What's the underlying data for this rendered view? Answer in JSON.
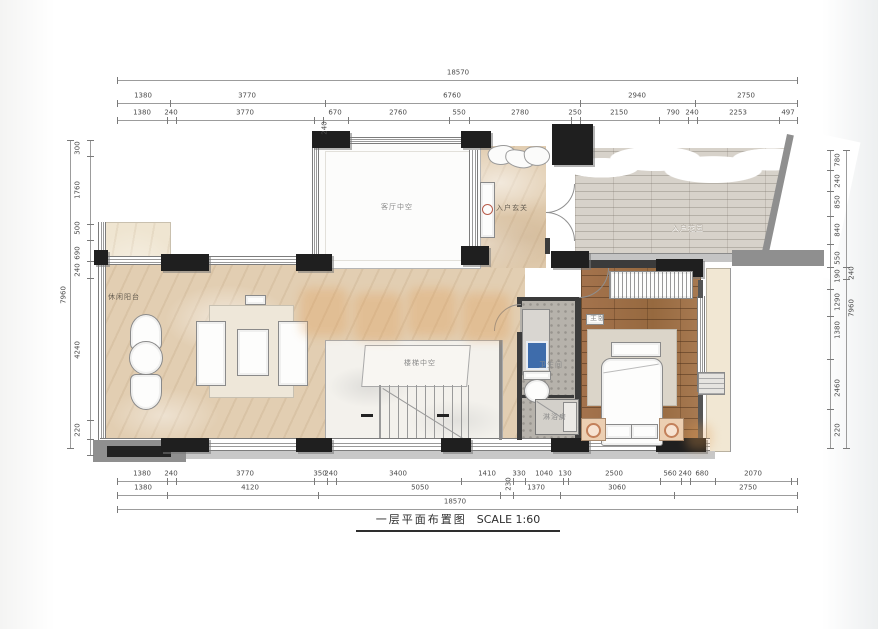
{
  "title": {
    "text": "一层平面布置图",
    "scale": "SCALE 1:60"
  },
  "rooms": {
    "labels": [
      {
        "t": "客厅中空",
        "x": 397,
        "y": 207,
        "cls": ""
      },
      {
        "t": "入户玄关",
        "x": 512,
        "y": 208,
        "cls": "onmarble"
      },
      {
        "t": "入户花园",
        "x": 688,
        "y": 228,
        "cls": "emboss"
      },
      {
        "t": "休闲阳台",
        "x": 124,
        "y": 297,
        "cls": "onmarble"
      },
      {
        "t": "楼梯中空",
        "x": 420,
        "y": 363,
        "cls": ""
      },
      {
        "t": "主卧",
        "x": 598,
        "y": 318,
        "cls": ""
      },
      {
        "t": "卫生间",
        "x": 551,
        "y": 365,
        "cls": ""
      },
      {
        "t": "淋浴房",
        "x": 555,
        "y": 417,
        "cls": ""
      }
    ]
  },
  "dimensions": {
    "unit": "mm",
    "overall": {
      "width": "18570",
      "height": "7960"
    },
    "top": {
      "rows": [
        {
          "y": 73,
          "items": [
            {
              "t": "18570",
              "x": 458
            }
          ]
        },
        {
          "y": 96,
          "items": [
            {
              "t": "1380",
              "x": 143
            },
            {
              "t": "3770",
              "x": 247
            },
            {
              "t": "6760",
              "x": 452
            },
            {
              "t": "2940",
              "x": 637
            },
            {
              "t": "2750",
              "x": 746
            }
          ]
        },
        {
          "y": 113,
          "items": [
            {
              "t": "1380",
              "x": 142
            },
            {
              "t": "240",
              "x": 171
            },
            {
              "t": "3770",
              "x": 245
            },
            {
              "t": "670",
              "x": 335
            },
            {
              "t": "2760",
              "x": 398
            },
            {
              "t": "550",
              "x": 459
            },
            {
              "t": "2780",
              "x": 520
            },
            {
              "t": "250",
              "x": 575
            },
            {
              "t": "2150",
              "x": 619
            },
            {
              "t": "790",
              "x": 673
            },
            {
              "t": "240",
              "x": 692
            },
            {
              "t": "2253",
              "x": 738
            },
            {
              "t": "497",
              "x": 788
            }
          ]
        }
      ]
    },
    "bottom": {
      "rows": [
        {
          "y": 474,
          "items": [
            {
              "t": "1380",
              "x": 142
            },
            {
              "t": "240",
              "x": 171
            },
            {
              "t": "3770",
              "x": 245
            },
            {
              "t": "350",
              "x": 320
            },
            {
              "t": "240",
              "x": 331
            },
            {
              "t": "3400",
              "x": 398
            },
            {
              "t": "1410",
              "x": 487
            },
            {
              "t": "330",
              "x": 519
            },
            {
              "t": "1040",
              "x": 544
            },
            {
              "t": "130",
              "x": 565
            },
            {
              "t": "2500",
              "x": 614
            },
            {
              "t": "560",
              "x": 670
            },
            {
              "t": "240",
              "x": 685
            },
            {
              "t": "680",
              "x": 702
            },
            {
              "t": "2070",
              "x": 753
            }
          ]
        },
        {
          "y": 488,
          "items": [
            {
              "t": "1380",
              "x": 143
            },
            {
              "t": "4120",
              "x": 250
            },
            {
              "t": "5050",
              "x": 420
            },
            {
              "t": "1370",
              "x": 536
            },
            {
              "t": "3060",
              "x": 617
            },
            {
              "t": "2750",
              "x": 748
            }
          ]
        },
        {
          "y": 502,
          "items": [
            {
              "t": "18570",
              "x": 455
            }
          ]
        }
      ]
    },
    "left": {
      "cols": [
        {
          "x": 64,
          "items": [
            {
              "t": "7960",
              "y": 295
            }
          ]
        },
        {
          "x": 78,
          "items": [
            {
              "t": "300",
              "y": 148
            },
            {
              "t": "1760",
              "y": 190
            },
            {
              "t": "500",
              "y": 228
            },
            {
              "t": "690",
              "y": 253
            },
            {
              "t": "240",
              "y": 270
            },
            {
              "t": "4240",
              "y": 350
            },
            {
              "t": "220",
              "y": 430
            }
          ]
        }
      ]
    },
    "right": {
      "cols": [
        {
          "x": 838,
          "items": [
            {
              "t": "780",
              "y": 160
            },
            {
              "t": "240",
              "y": 181
            },
            {
              "t": "850",
              "y": 202
            },
            {
              "t": "840",
              "y": 230
            },
            {
              "t": "550",
              "y": 258
            },
            {
              "t": "190",
              "y": 276
            },
            {
              "t": "1290",
              "y": 302
            },
            {
              "t": "1380",
              "y": 330
            },
            {
              "t": "2460",
              "y": 388
            },
            {
              "t": "220",
              "y": 430
            }
          ]
        },
        {
          "x": 852,
          "items": [
            {
              "t": "240",
              "y": 273
            },
            {
              "t": "7960",
              "y": 308
            }
          ]
        }
      ]
    },
    "rotated_extras": [
      {
        "t": "240",
        "x": 325,
        "y": 128
      },
      {
        "t": "230",
        "x": 509,
        "y": 484
      }
    ],
    "lines": [
      {
        "o": "h",
        "p": 80,
        "a": 117,
        "b": 797,
        "ticks": [
          117,
          797
        ]
      },
      {
        "o": "h",
        "p": 103,
        "a": 117,
        "b": 797,
        "ticks": [
          117,
          170,
          325,
          580,
          695,
          797
        ]
      },
      {
        "o": "h",
        "p": 120,
        "a": 117,
        "b": 797,
        "ticks": [
          117,
          167,
          176,
          314,
          323,
          348,
          449,
          469,
          571,
          580,
          659,
          688,
          697,
          779,
          797
        ]
      },
      {
        "o": "h",
        "p": 481,
        "a": 117,
        "b": 797,
        "ticks": [
          117,
          167,
          176,
          314,
          327,
          336,
          461,
          513,
          525,
          563,
          568,
          660,
          681,
          690,
          715,
          791,
          797
        ]
      },
      {
        "o": "h",
        "p": 495,
        "a": 117,
        "b": 797,
        "ticks": [
          117,
          167,
          318,
          500,
          513,
          560,
          674,
          797
        ]
      },
      {
        "o": "h",
        "p": 509,
        "a": 117,
        "b": 797,
        "ticks": [
          117,
          797
        ]
      },
      {
        "o": "v",
        "p": 70,
        "a": 140,
        "b": 448,
        "ticks": [
          140,
          448
        ]
      },
      {
        "o": "v",
        "p": 90,
        "a": 140,
        "b": 455,
        "ticks": [
          140,
          156,
          224,
          240,
          261,
          278,
          420,
          439,
          455
        ]
      },
      {
        "o": "v",
        "p": 830,
        "a": 150,
        "b": 448,
        "ticks": [
          150,
          170,
          191,
          216,
          244,
          267,
          289,
          316,
          359,
          409,
          448
        ]
      },
      {
        "o": "v",
        "p": 846,
        "a": 150,
        "b": 448,
        "ticks": [
          150,
          267,
          279,
          448
        ]
      }
    ]
  },
  "colors": {
    "marble_floor": "#e2ceb2",
    "wood_floor": "#9d6f49",
    "deck_floor": "#d7d2ca",
    "tile_floor": "#b6b2ab",
    "wall_dark": "#1f1f1f",
    "wall_gray": "#8f8f8f",
    "dimension_text": "#4c4c4c",
    "watermark": "#e09a50",
    "sink_blue": "#3e6cab"
  }
}
